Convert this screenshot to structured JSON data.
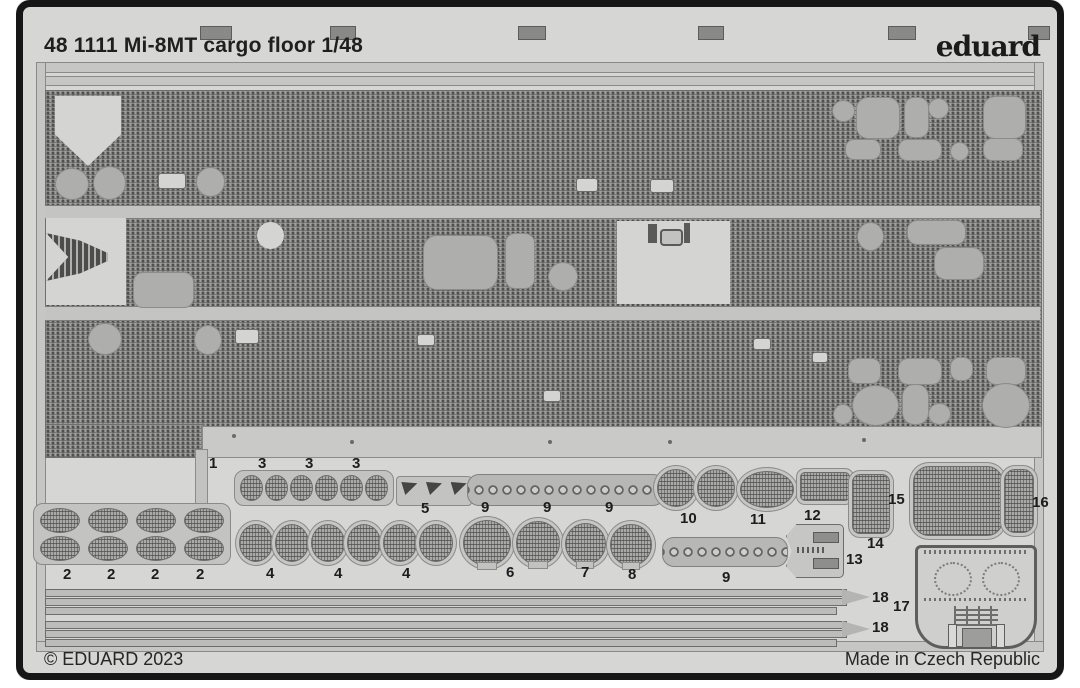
{
  "header": {
    "title": "48 1111 Mi-8MT cargo floor 1/48",
    "brand": "eduard"
  },
  "footer": {
    "copyright": "© EDUARD 2023",
    "origin": "Made in Czech Republic"
  },
  "sheet": {
    "subject": "photo-etched fret with textured cargo floor panels and numbered small parts",
    "part_labels": [
      "1",
      "3",
      "3",
      "3",
      "5",
      "9",
      "9",
      "9",
      "10",
      "11",
      "12",
      "15",
      "16",
      "2",
      "2",
      "2",
      "2",
      "4",
      "4",
      "4",
      "6",
      "7",
      "8",
      "9",
      "13",
      "14",
      "17",
      "18",
      "18"
    ]
  },
  "colors": {
    "photo_background": "#d6d6d4",
    "frame_border": "#161616",
    "etched_metal": "#a0a09e",
    "plain_metal": "#aeaeac",
    "text": "#1f1f1f"
  }
}
